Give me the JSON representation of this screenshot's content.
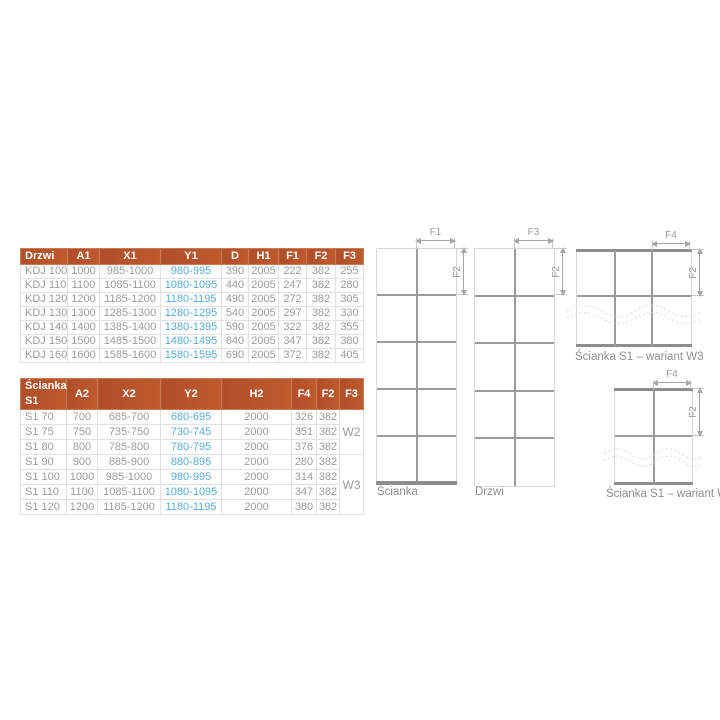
{
  "colors": {
    "header_bg": "#b5512c",
    "header_text": "#ffffff",
    "body_text": "#9c9c9c",
    "accent_blue": "#58acdd",
    "cell_border": "#e2e2e2",
    "group_border": "#b4b4b4",
    "line_dark": "#9b9b9b",
    "line_light": "#d8d8d8",
    "profile_bar": "#8e8e8e"
  },
  "tables": {
    "doors": {
      "headers": [
        "Drzwi",
        "A1",
        "X1",
        "Y1",
        "D",
        "H1",
        "F1",
        "F2",
        "F3"
      ],
      "accent_cols": [
        3
      ],
      "rows": [
        [
          "KDJ 100",
          "1000",
          "985-1000",
          "980-995",
          "390",
          "2005",
          "222",
          "382",
          "255"
        ],
        [
          "KDJ 110",
          "1100",
          "1085-1100",
          "1080-1095",
          "440",
          "2005",
          "247",
          "382",
          "280"
        ],
        [
          "KDJ 120",
          "1200",
          "1185-1200",
          "1180-1195",
          "490",
          "2005",
          "272",
          "382",
          "305"
        ],
        [
          "KDJ 130",
          "1300",
          "1285-1300",
          "1280-1295",
          "540",
          "2005",
          "297",
          "382",
          "330"
        ],
        [
          "KDJ 140",
          "1400",
          "1385-1400",
          "1380-1395",
          "590",
          "2005",
          "322",
          "382",
          "355"
        ],
        [
          "KDJ 150",
          "1500",
          "1485-1500",
          "1480-1495",
          "640",
          "2005",
          "347",
          "382",
          "380"
        ],
        [
          "KDJ 160",
          "1600",
          "1585-1600",
          "1580-1595",
          "690",
          "2005",
          "372",
          "382",
          "405"
        ]
      ]
    },
    "walls": {
      "headers": [
        "Ścianka S1",
        "A2",
        "X2",
        "Y2",
        "H2",
        "F4",
        "F2",
        "F3"
      ],
      "accent_cols": [
        3
      ],
      "variant_groups": [
        {
          "label": "W2",
          "span": 3
        },
        {
          "label": "W3",
          "span": 4
        }
      ],
      "rows": [
        [
          "S1 70",
          "700",
          "685-700",
          "680-695",
          "2000",
          "326",
          "382"
        ],
        [
          "S1 75",
          "750",
          "735-750",
          "730-745",
          "2000",
          "351",
          "382"
        ],
        [
          "S1 80",
          "800",
          "785-800",
          "780-795",
          "2000",
          "376",
          "382"
        ],
        [
          "S1 90",
          "900",
          "885-900",
          "880-895",
          "2000",
          "280",
          "382"
        ],
        [
          "S1 100",
          "1000",
          "985-1000",
          "980-995",
          "2000",
          "314",
          "382"
        ],
        [
          "S1 110",
          "1100",
          "1085-1100",
          "1080-1095",
          "2000",
          "347",
          "382"
        ],
        [
          "S1 120",
          "1200",
          "1185-1200",
          "1180-1195",
          "2000",
          "380",
          "382"
        ]
      ]
    }
  },
  "diagrams": {
    "scianka": {
      "label": "Ścianka",
      "dim_top": "F1",
      "dim_side": "F2"
    },
    "drzwi": {
      "label": "Drzwi",
      "dim_top": "F3",
      "dim_side": "F2"
    },
    "w3": {
      "label": "Ścianka S1 – wariant W3",
      "dim_top": "F4",
      "dim_side": "F2"
    },
    "w2": {
      "label": "Ścianka S1 – wariant W2",
      "dim_top": "F4",
      "dim_side": "F2"
    }
  }
}
